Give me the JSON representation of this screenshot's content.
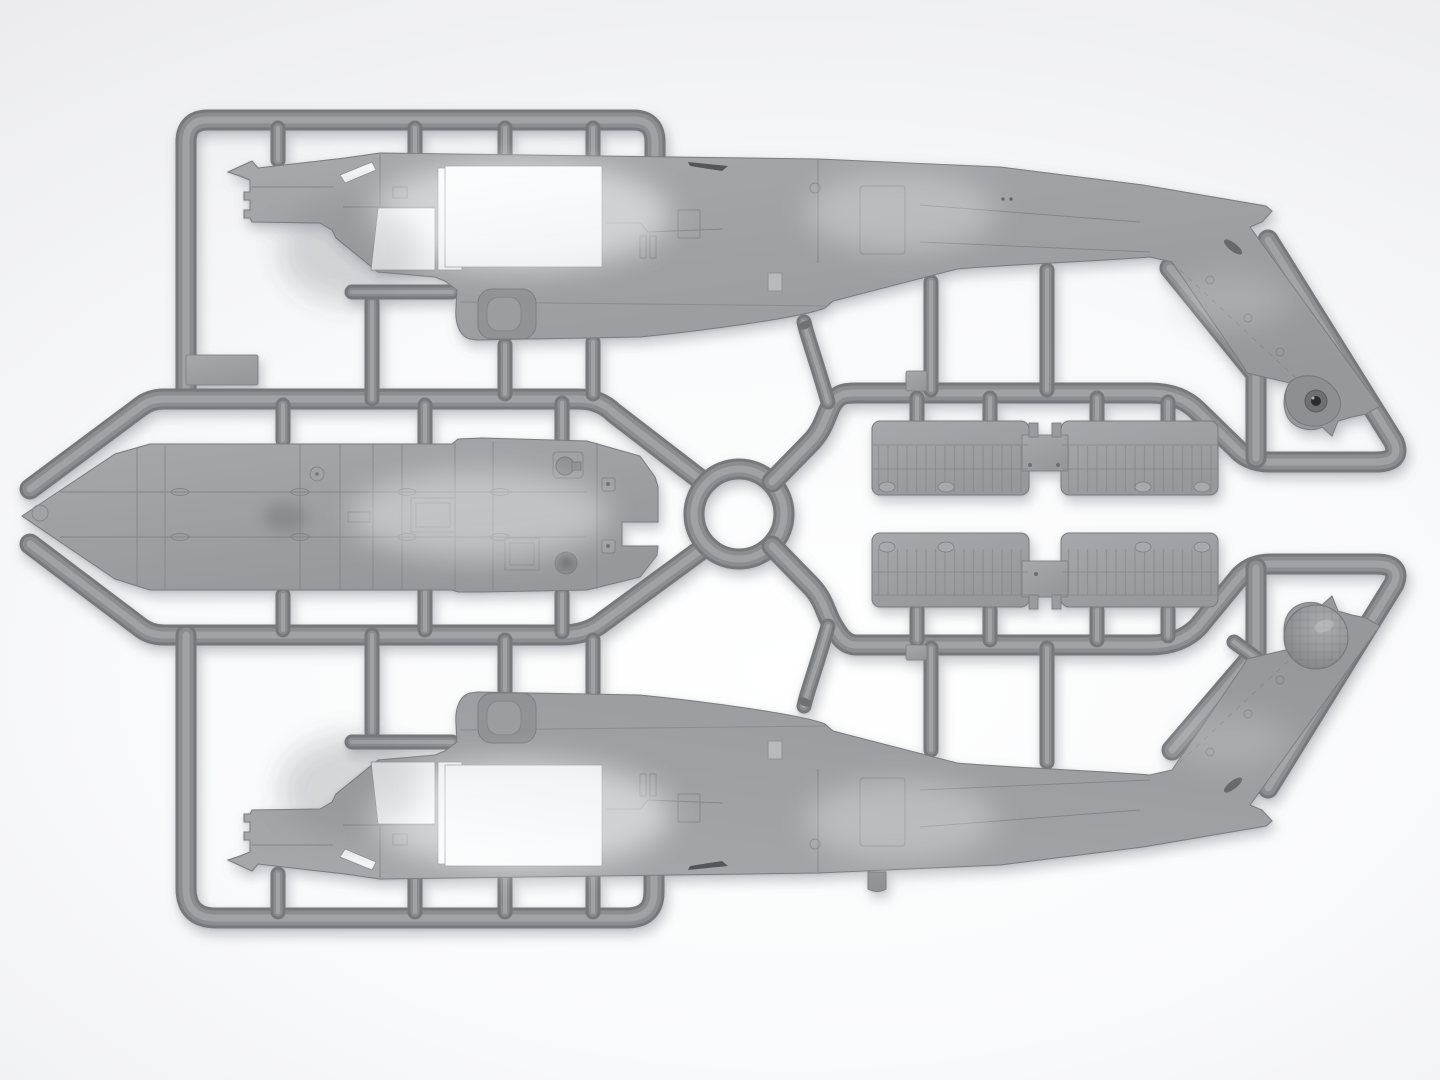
{
  "scene": {
    "type": "product-render",
    "subject": "grey styrene model-kit sprue with helicopter fuselage parts",
    "parts": [
      {
        "id": "fuselage-top",
        "label": "fuselage half, nose left, tail boom angled down-right, teardrop tail-rotor hub fairing"
      },
      {
        "id": "fuselage-bottom",
        "label": "mirrored fuselage half, nose left, tail boom angled up-right, dome fairing"
      },
      {
        "id": "roof-panel",
        "label": "long top-view roof/floor panel with pointed nose at left"
      },
      {
        "id": "cowling-upper",
        "label": "two ribbed cowling panels joined by centre bridge (upper)"
      },
      {
        "id": "cowling-lower",
        "label": "two ribbed cowling panels joined by centre bridge (lower)"
      },
      {
        "id": "runner-frame",
        "label": "rounded sprue runner frame with centre ring and diagonal feeds"
      }
    ]
  },
  "colors": {
    "background_edge": "#e5e6e8",
    "background_center": "#ffffff",
    "runner_dark": "#76787c",
    "runner_mid": "#8b8d91",
    "runner_light": "#a0a2a6",
    "plastic_light": "#a7a8ab",
    "plastic_base": "#97989b",
    "plastic_dark": "#8a8b8f",
    "plastic_outline": "#7a7c80",
    "panel_line": "#84858a",
    "hole_light": "#fbfcfd",
    "hole_dark": "#e9ebee",
    "hub_dark": "#2c2d2f",
    "hub_mid": "#6f7073",
    "slot_dark": "#66676b",
    "shadow": "#7d808a"
  }
}
